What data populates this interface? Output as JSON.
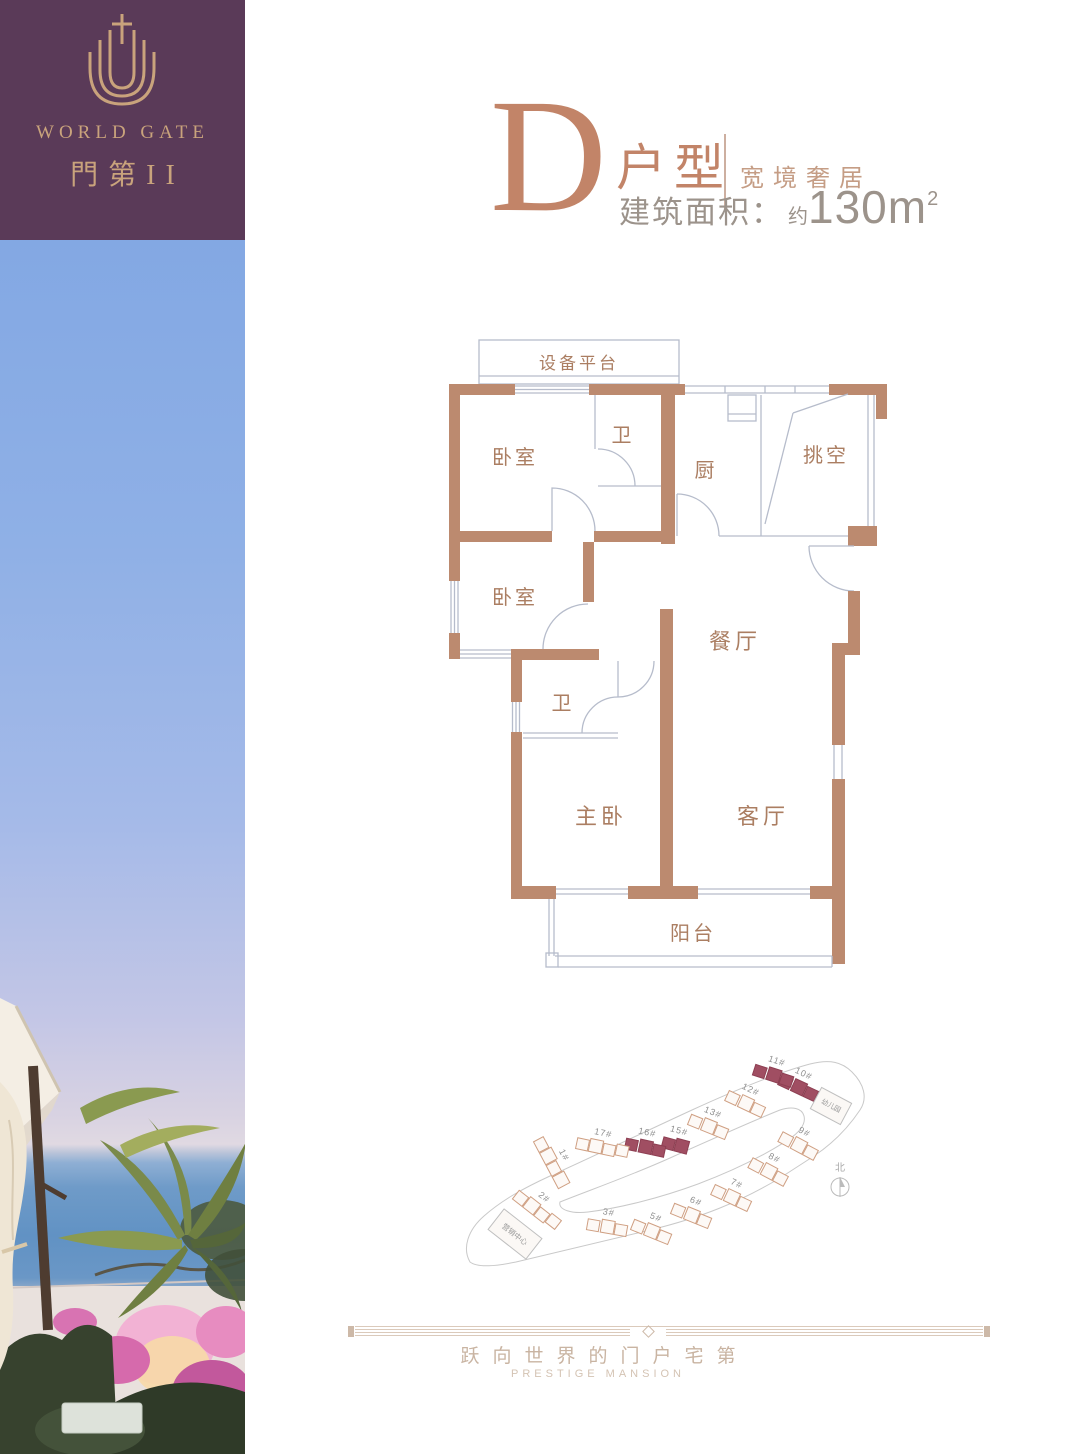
{
  "brand": {
    "name_en": "WORLD GATE",
    "name_cn": "門第II"
  },
  "header": {
    "unit_letter": "D",
    "unit_word": "户型",
    "tagline": "宽境奢居",
    "area_label": "建筑面积：",
    "area_approx": "约",
    "area_value": "130m",
    "area_superscript": "2"
  },
  "floorplan": {
    "rooms": [
      {
        "label": "设备平台"
      },
      {
        "label": "卧室"
      },
      {
        "label": "卫"
      },
      {
        "label": "厨"
      },
      {
        "label": "挑空"
      },
      {
        "label": "卧室"
      },
      {
        "label": "餐厅"
      },
      {
        "label": "卫"
      },
      {
        "label": "主卧"
      },
      {
        "label": "客厅"
      },
      {
        "label": "阳台"
      }
    ]
  },
  "siteplan": {
    "buildings": [
      {
        "label": "1#",
        "highlighted": false
      },
      {
        "label": "2#",
        "highlighted": false
      },
      {
        "label": "3#",
        "highlighted": false
      },
      {
        "label": "5#",
        "highlighted": false
      },
      {
        "label": "6#",
        "highlighted": false
      },
      {
        "label": "7#",
        "highlighted": false
      },
      {
        "label": "8#",
        "highlighted": false
      },
      {
        "label": "9#",
        "highlighted": false
      },
      {
        "label": "10#",
        "highlighted": true
      },
      {
        "label": "11#",
        "highlighted": true
      },
      {
        "label": "12#",
        "highlighted": false
      },
      {
        "label": "13#",
        "highlighted": false
      },
      {
        "label": "15#",
        "highlighted": true
      },
      {
        "label": "16#",
        "highlighted": true
      },
      {
        "label": "17#",
        "highlighted": false
      }
    ],
    "kindergarten": "幼儿园",
    "marketing_center": "营销中心",
    "north": "北"
  },
  "footer": {
    "slogan_cn": "跃向世界的门户宅第",
    "slogan_en": "PRESTIGE MANSION"
  },
  "colors": {
    "brand_purple": "#5a3a58",
    "brand_gold": "#c9a37c",
    "title_terracotta": "#c28468",
    "wall_tan": "#bc8a6f",
    "thin_line": "#b6bccb",
    "room_label": "#ab7e62",
    "highlight_maroon": "#a04e62",
    "area_text": "#9c938b",
    "footer_text": "#c9b4a2"
  }
}
